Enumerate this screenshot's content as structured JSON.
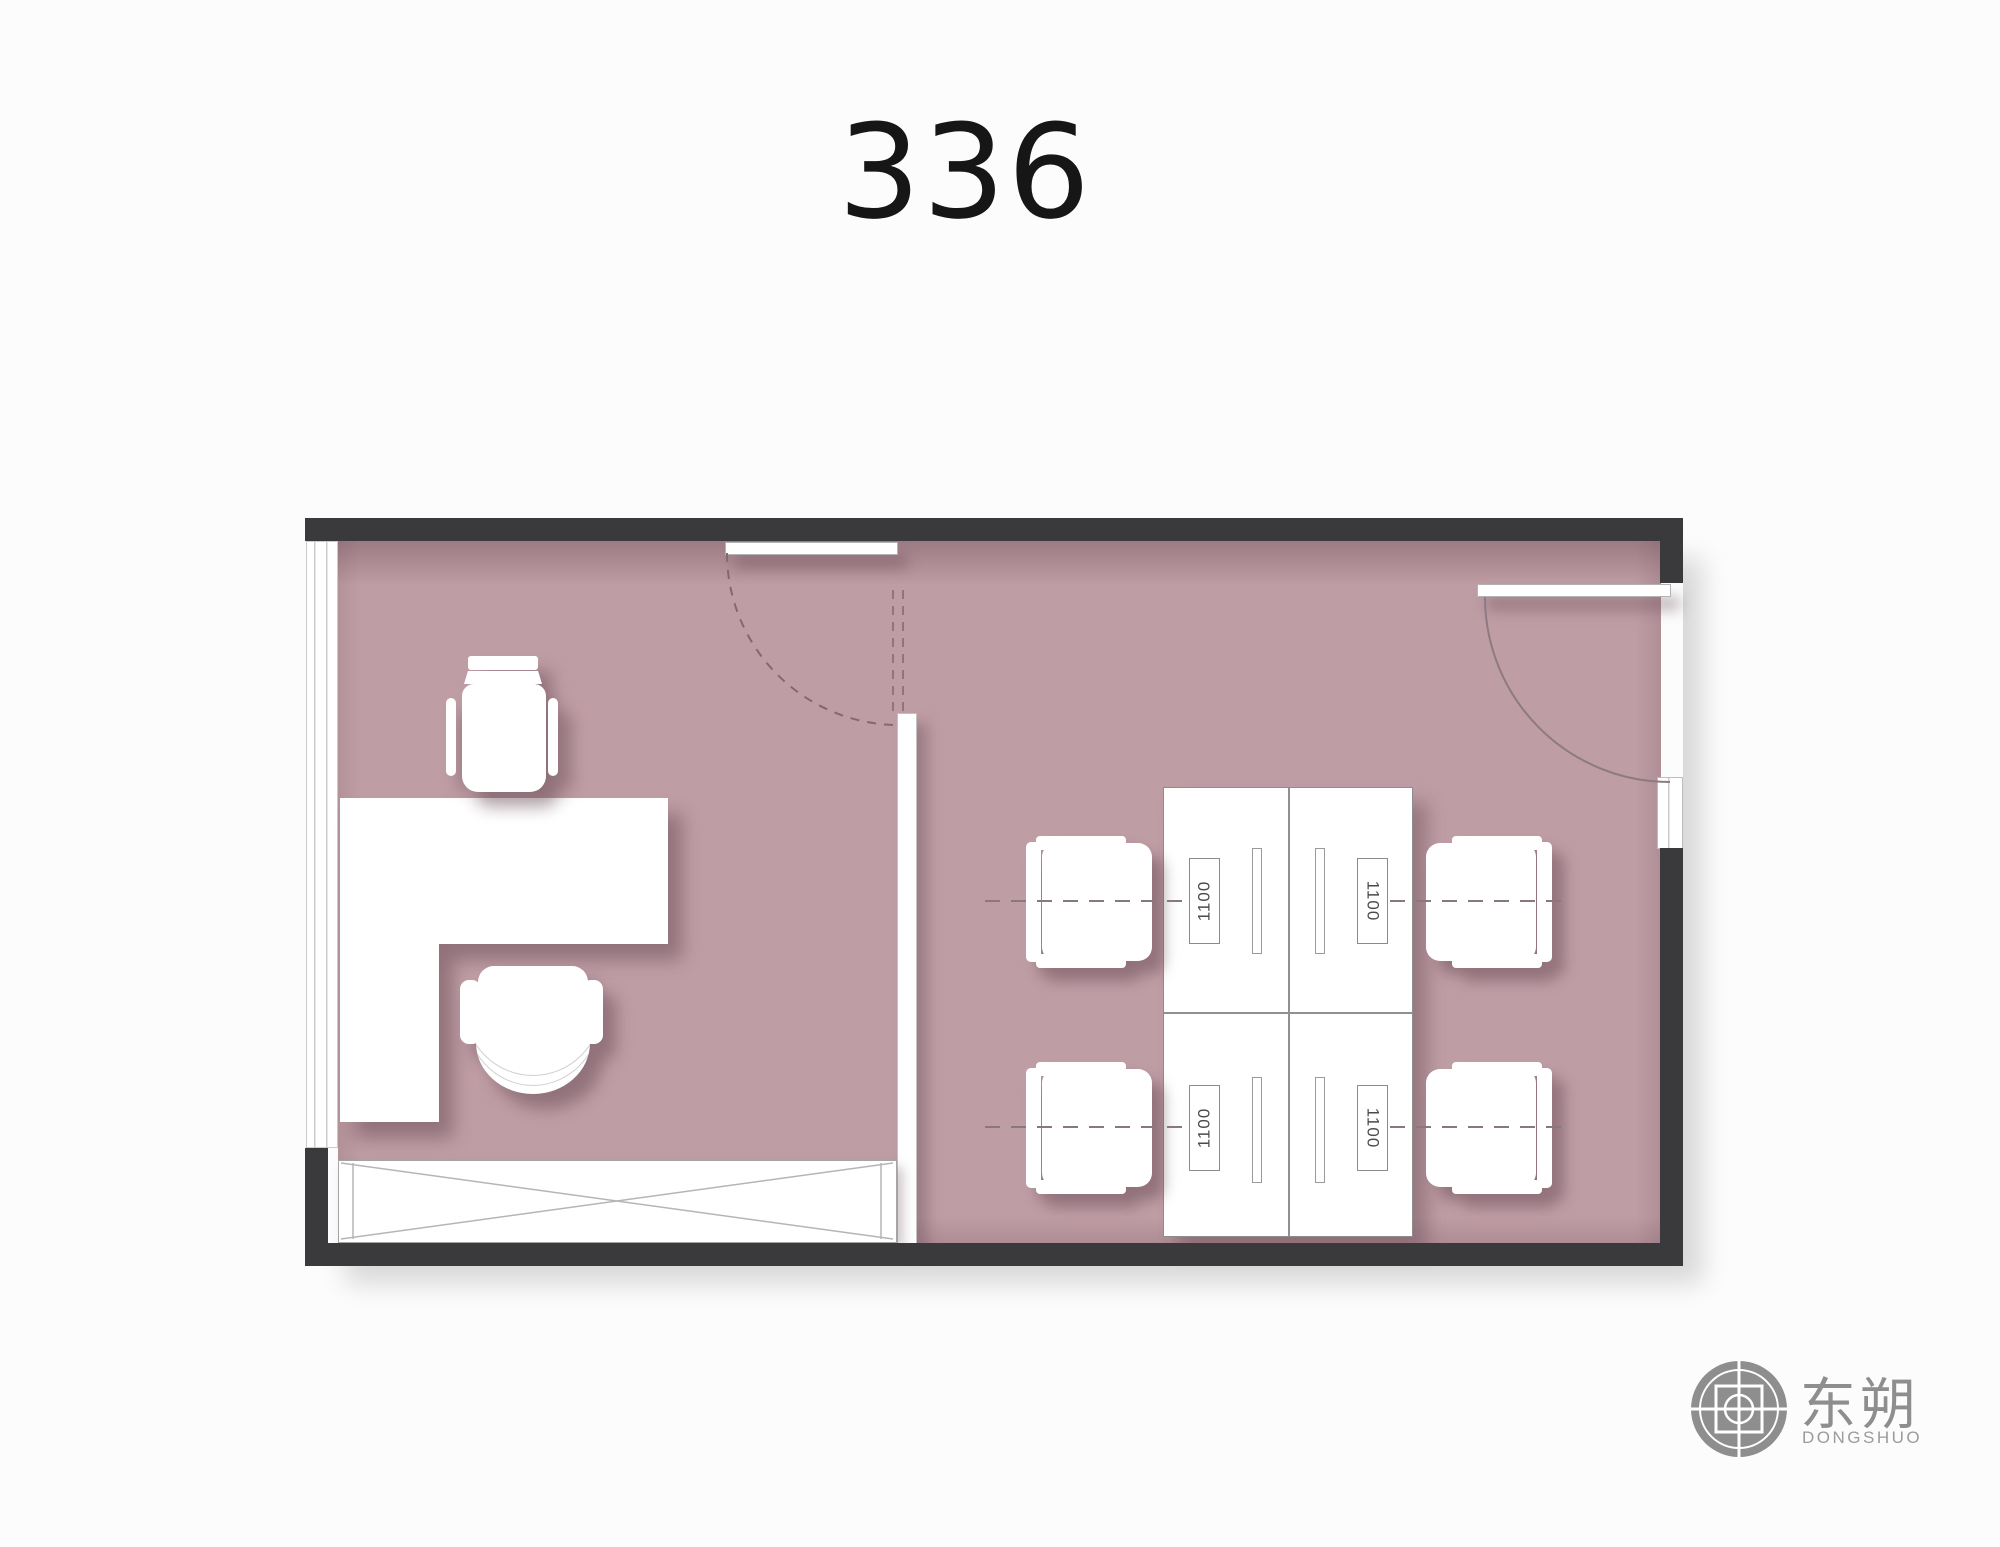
{
  "title": "336",
  "plan": {
    "floor_color": "#bf9da5",
    "wall_color": "#3a3a3c",
    "workstations": [
      {
        "label": "1100"
      },
      {
        "label": "1100"
      },
      {
        "label": "1100"
      },
      {
        "label": "1100"
      }
    ]
  },
  "logo": {
    "name_zh": "东朔",
    "name_en": "DONGSHUO",
    "color": "#8e8e8e"
  }
}
